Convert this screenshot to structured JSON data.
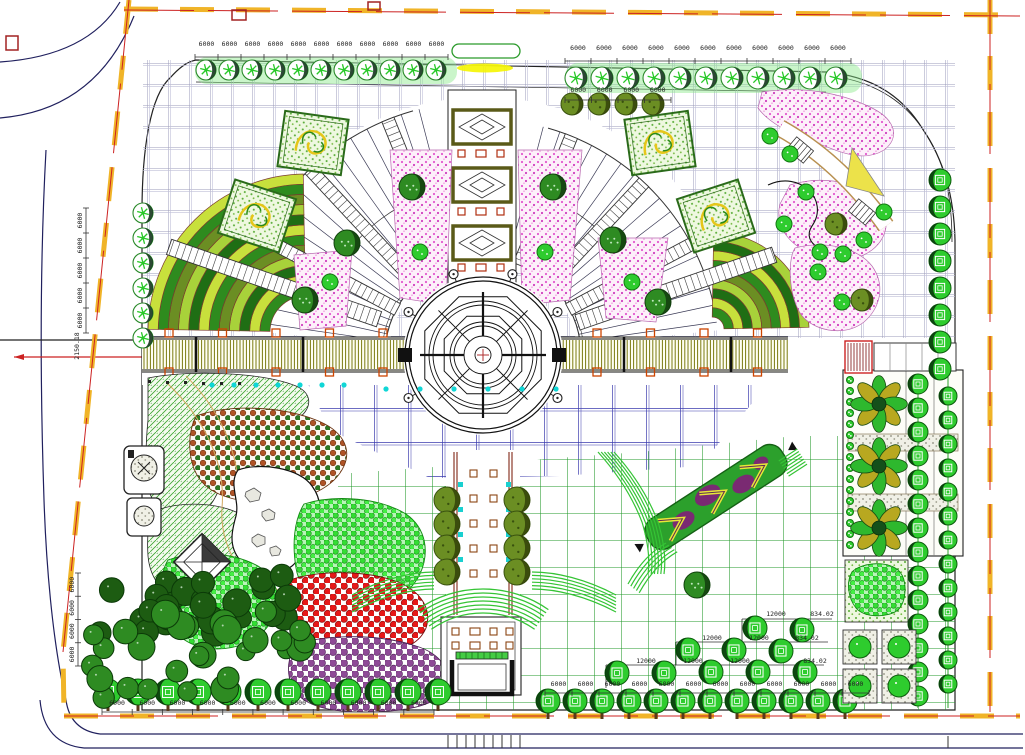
{
  "drawing": {
    "type": "landscape-site-plan",
    "description": "CAD master plan of a public square with central circular fountain, radial paved fans, pergola, flower beds, tree planting and roads"
  },
  "colors": {
    "boundary_yellow": "#f0b428",
    "boundary_red": "#cc2222",
    "road": "#20205e",
    "outline": "#222222",
    "ray": "#3a3a55",
    "grid_gray": "#9a9ab8",
    "grid_blue": "#3c3cae",
    "grid_green": "#22992a",
    "pink": "#e358cf",
    "fan_bands": [
      "#2e8b1e",
      "#c8e03c",
      "#1f6e14",
      "#a8d23a",
      "#6b8e23"
    ],
    "tree_green": "#2ecc2e",
    "tree_dark": "#0d5c0d",
    "olive": "#6b8e23",
    "red_mass": "#e61818",
    "purple_mass": "#8e4a96",
    "brown_mass": "#b05326",
    "bright_mass": "#33dd33",
    "dark_cluster": "#1d5c12",
    "mid_cluster": "#2e8b22",
    "pergola_slat": "#7a7a10",
    "pergola_post": "#cc4400",
    "cyan": "#10d6d6",
    "ramp_green": "#2ca02c",
    "ramp_purple": "#7a2a72",
    "ramp_chevron": "#e8e838",
    "steps_green": "#35c435"
  },
  "dims": {
    "rows": [
      {
        "label": "6000",
        "n": 11,
        "x1": 195,
        "x2": 448,
        "y": 46,
        "ty": 57
      },
      {
        "label": "6000",
        "n": 11,
        "x1": 565,
        "x2": 851,
        "y": 50,
        "ty": 61
      },
      {
        "label": "6000",
        "n": 4,
        "x1": 565,
        "x2": 671,
        "y": 92,
        "ty": 100
      },
      {
        "label": "6000",
        "n": 5,
        "vert": true,
        "x": 86,
        "y1": 208,
        "y2": 333
      },
      {
        "label": "6000",
        "n": 4,
        "vert": true,
        "x": 78,
        "y1": 573,
        "y2": 666
      },
      {
        "label": "6000",
        "n": 11,
        "x1": 102,
        "x2": 434,
        "y": 705,
        "ty": 712
      },
      {
        "label": "6000",
        "n": 12,
        "x1": 545,
        "x2": 869,
        "y": 686,
        "ty": 693
      }
    ]
  },
  "annotations": [
    {
      "t": "12000",
      "x": 776,
      "y": 616
    },
    {
      "t": "834.02",
      "x": 822,
      "y": 616
    },
    {
      "t": "12000",
      "x": 712,
      "y": 640
    },
    {
      "t": "12000",
      "x": 759,
      "y": 640
    },
    {
      "t": "834.02",
      "x": 807,
      "y": 640
    },
    {
      "t": "12000",
      "x": 646,
      "y": 663
    },
    {
      "t": "12000",
      "x": 693,
      "y": 663
    },
    {
      "t": "12000",
      "x": 740,
      "y": 663
    },
    {
      "t": "834.02",
      "x": 815,
      "y": 663
    },
    {
      "t": "2150.18",
      "x": 79,
      "y": 346,
      "rot": -90
    }
  ],
  "fountain": {
    "cx": 483,
    "cy": 355,
    "rings": [
      78,
      74,
      54,
      50,
      33,
      29,
      19,
      8
    ],
    "octagons": [
      63,
      42
    ],
    "lamp_r": 86,
    "lamp_angles": [
      30,
      70,
      110,
      150,
      210,
      330
    ]
  },
  "sunburst": {
    "r0": 98,
    "r_left": 254,
    "r_right": 236,
    "a0": 8,
    "a1": 172,
    "gap0": 76,
    "gap1": 104,
    "step": 4.2
  },
  "fans": [
    {
      "cx": 306,
      "cy": 332,
      "r0": 36,
      "r1": 158,
      "a0": 91,
      "a1": 179,
      "bands": 12
    },
    {
      "cx": 712,
      "cy": 329,
      "r0": 12,
      "r1": 97,
      "a0": 1,
      "a1": 89,
      "bands": 9
    }
  ],
  "ladders": {
    "short_angles": [
      28,
      47,
      68,
      112,
      133,
      152
    ],
    "long": [
      {
        "a": 19,
        "r0": 100,
        "r1": 308
      },
      {
        "a": 161,
        "r0": 110,
        "r1": 332
      }
    ]
  },
  "pergola": {
    "x1": 142,
    "x2": 788,
    "y1": 337,
    "y2": 372,
    "slat_step": 3.2,
    "post_step": 53.5,
    "col_step": 107
  },
  "planting": {
    "rows": [
      {
        "id": "tree-row-top-left",
        "type": "A",
        "r": 10,
        "y": 70,
        "x0": 206,
        "step": 23,
        "n": 11
      },
      {
        "id": "tree-row-top-right",
        "type": "A",
        "r": 11,
        "y": 78,
        "x0": 576,
        "step": 26,
        "n": 11
      },
      {
        "id": "tree-row-top-inner",
        "type": "O",
        "r": 11,
        "y": 104,
        "x0": 572,
        "step": 27,
        "n": 4
      },
      {
        "id": "tree-col-left-edge",
        "type": "A",
        "r": 10,
        "x": 143,
        "y0": 213,
        "step": 25,
        "n": 6,
        "vert": true
      },
      {
        "id": "tree-col-right-edge",
        "type": "B",
        "r": 11,
        "x": 940,
        "y0": 180,
        "step": 27,
        "n": 8,
        "vert": true
      },
      {
        "id": "tree-col-axis-west",
        "type": "O",
        "r": 13,
        "x": 447,
        "y0": 500,
        "step": 24,
        "n": 4,
        "vert": true
      },
      {
        "id": "tree-col-axis-east",
        "type": "O",
        "r": 13,
        "x": 517,
        "y0": 500,
        "step": 24,
        "n": 4,
        "vert": true
      },
      {
        "id": "tree-row-bottom-left",
        "type": "B",
        "r": 13,
        "y": 692,
        "x0": 108,
        "step": 30,
        "n": 12,
        "trunk": true
      },
      {
        "id": "tree-row-bottom-right",
        "type": "B",
        "r": 12,
        "y": 701,
        "x0": 548,
        "step": 27,
        "n": 12,
        "trunk": true
      },
      {
        "id": "tree-col-grove-1",
        "type": "B",
        "r": 10,
        "x": 918,
        "y0": 384,
        "step": 24,
        "n": 14,
        "vert": true
      },
      {
        "id": "tree-col-grove-2",
        "type": "B",
        "r": 9,
        "x": 948,
        "y0": 396,
        "step": 24,
        "n": 13,
        "vert": true
      },
      {
        "id": "shrub-col-grove-edge",
        "type": "S",
        "r": 3.5,
        "x": 850,
        "y0": 380,
        "step": 11,
        "n": 16,
        "vert": true
      }
    ],
    "scatter": [
      {
        "id": "round-trees-plaza",
        "type": "R",
        "r": 13,
        "pts": [
          [
            347,
            243
          ],
          [
            305,
            300
          ],
          [
            412,
            187
          ],
          [
            553,
            187
          ],
          [
            613,
            240
          ],
          [
            658,
            302
          ],
          [
            697,
            585
          ]
        ]
      },
      {
        "id": "olive-trees-corner",
        "type": "O",
        "r": 11,
        "pts": [
          [
            836,
            224
          ],
          [
            862,
            300
          ]
        ]
      },
      {
        "id": "shrubs-on-pink",
        "type": "S",
        "r": 8,
        "pts": [
          [
            420,
            252
          ],
          [
            545,
            252
          ],
          [
            632,
            282
          ],
          [
            330,
            282
          ],
          [
            770,
            136
          ],
          [
            790,
            154
          ],
          [
            806,
            192
          ],
          [
            784,
            224
          ],
          [
            820,
            252
          ],
          [
            843,
            254
          ],
          [
            864,
            240
          ],
          [
            884,
            212
          ],
          [
            818,
            272
          ],
          [
            842,
            302
          ]
        ]
      },
      {
        "id": "stepped-trees-southeast",
        "type": "B",
        "r": 12,
        "pts": [
          [
            755,
            628
          ],
          [
            802,
            630
          ],
          [
            688,
            650
          ],
          [
            734,
            650
          ],
          [
            781,
            651
          ],
          [
            617,
            673
          ],
          [
            664,
            673
          ],
          [
            711,
            672
          ],
          [
            758,
            672
          ],
          [
            805,
            672
          ]
        ]
      },
      {
        "id": "flower-trees-grove",
        "type": "F",
        "r": 27,
        "pts": [
          [
            879,
            404
          ],
          [
            879,
            466
          ],
          [
            879,
            528
          ]
        ]
      }
    ],
    "clusters": [
      {
        "x": 100,
        "y": 572,
        "w": 200,
        "h": 66,
        "n": 26,
        "r": 12,
        "fill": "#1d5c12"
      },
      {
        "x": 92,
        "y": 614,
        "w": 150,
        "h": 84,
        "n": 20,
        "r": 12,
        "fill": "#2e8b22"
      },
      {
        "x": 238,
        "y": 598,
        "w": 70,
        "h": 58,
        "n": 8,
        "r": 11,
        "fill": "#2e8b22"
      }
    ],
    "planters": {
      "x0": 843,
      "y0": 630,
      "size": 34,
      "gap": 5,
      "rows": 2,
      "cols": 2
    }
  },
  "cyan_dots": [
    {
      "y": 385,
      "x0": 212,
      "step": 22,
      "n": 7
    },
    {
      "y": 389,
      "x0": 386,
      "step": 34,
      "n": 6
    }
  ]
}
